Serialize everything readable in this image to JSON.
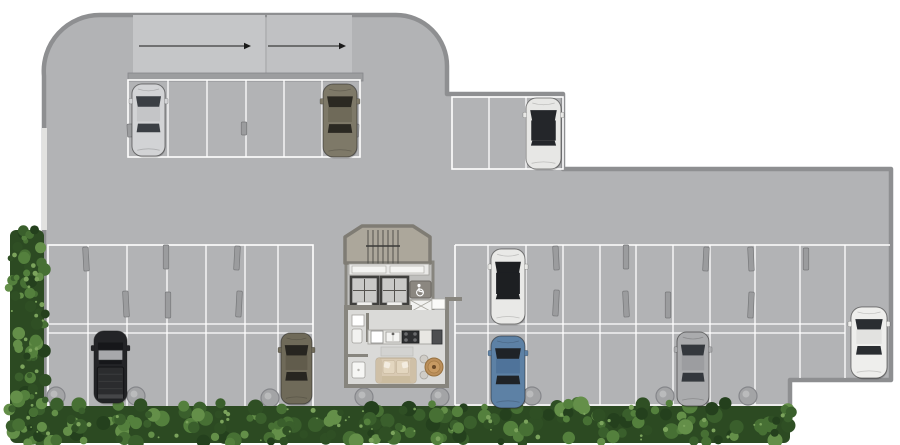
{
  "meta": {
    "title": "parking-level-floor-plan",
    "canvas": {
      "w": 900,
      "h": 445
    }
  },
  "palette": {
    "floor": "#b2b3b5",
    "wall": "#8e8f91",
    "line": "#ffffff",
    "ramp": "#c5c6c8",
    "ramp2": "#c0c1c3",
    "band": "#9c9d9f",
    "stop_fill": "#9b9c9e",
    "stop_edge": "#77787a",
    "column_fill": "#a3a4a6",
    "column_edge": "#85868a",
    "core_wall": "#87857e",
    "stair_floor": "#aca79b",
    "lobby_floor": "#dadad8",
    "elevator_frame": "#3f3f3d",
    "elevator_cab": "#c9c9c7",
    "sofa": "#d9cab3",
    "table": "#bb8f5b",
    "counter": "#e8e7e3",
    "arrow": "#1a1a1a"
  },
  "building": {
    "outline": "M 100,15 H 396 A 51 51 0 0 1 447,66 V 94 H 563 V 169 H 891 V 380 H 790 V 411 H 44 V 76 A 56 56 0 0 1 100,15 Z",
    "ramp_panels": [
      [
        133,
        15,
        132,
        58
      ],
      [
        267,
        15,
        85,
        58
      ]
    ],
    "wall_band": [
      128,
      73,
      235,
      8
    ],
    "left_wall_light": [
      42,
      128,
      5,
      102
    ]
  },
  "ramp_arrows": [
    {
      "x1": 139,
      "y": 46,
      "x2": 251
    },
    {
      "x1": 268,
      "y": 46,
      "x2": 346
    }
  ],
  "parking": {
    "sections": [
      {
        "name": "row-top-left",
        "box": [
          128,
          80,
          360,
          157
        ],
        "dividers": [
          168,
          207,
          246,
          284,
          322
        ]
      },
      {
        "name": "row-top-right",
        "box": [
          452,
          97,
          563,
          169
        ],
        "dividers": [
          489,
          526
        ]
      },
      {
        "name": "section-lower-left",
        "box": [
          48,
          245,
          313,
          408
        ],
        "dividers": [
          88,
          127,
          167,
          206,
          245,
          278
        ],
        "mid": [
          324,
          333
        ]
      },
      {
        "name": "section-lower-right",
        "box": [
          455,
          245,
          890,
          405
        ],
        "dividers": [
          488,
          526,
          563,
          600,
          636,
          673,
          710,
          755
        ],
        "dividers_short": [
          800,
          845
        ],
        "short_y2": 378,
        "mid": [
          324,
          333
        ],
        "mid_end": 845,
        "bottom_end": 790
      }
    ],
    "wheel_stops": [
      [
        130,
        124,
        13
      ],
      [
        244,
        122,
        13
      ],
      [
        356,
        124,
        13
      ],
      [
        86,
        247,
        24
      ],
      [
        166,
        245,
        24
      ],
      [
        237,
        246,
        24
      ],
      [
        126,
        291,
        26
      ],
      [
        168,
        292,
        26
      ],
      [
        239,
        291,
        26
      ],
      [
        556,
        246,
        24
      ],
      [
        626,
        245,
        24
      ],
      [
        706,
        247,
        24
      ],
      [
        751,
        247,
        24
      ],
      [
        806,
        248,
        22
      ],
      [
        556,
        290,
        26
      ],
      [
        626,
        291,
        26
      ],
      [
        668,
        292,
        26
      ],
      [
        751,
        292,
        26
      ]
    ],
    "columns": [
      [
        56,
        396
      ],
      [
        136,
        396
      ],
      [
        270,
        398
      ],
      [
        364,
        397
      ],
      [
        440,
        397
      ],
      [
        532,
        396
      ],
      [
        665,
        396
      ],
      [
        748,
        396
      ]
    ],
    "column_radius": 9
  },
  "landscaping": {
    "hedge_left": [
      10,
      230,
      34,
      213
    ],
    "hedge_bottom": [
      30,
      406,
      760,
      37
    ],
    "greens": [
      "#24401d",
      "#2f4f24",
      "#3a5f2c",
      "#477034",
      "#54803d",
      "#648f49"
    ],
    "highlight": "#7ba35c",
    "base": "#2c4a22"
  },
  "core": {
    "stair_hall": {
      "points": "345,263 345,237 362,226 413,226 430,237 430,263"
    },
    "rail": {
      "x1": 368,
      "x2": 398,
      "count": 7,
      "y1": 230,
      "y2": 264,
      "bar_y": 246,
      "bar_x1": 366,
      "bar_x2": 400
    },
    "elevator_block": [
      346,
      262,
      87,
      48
    ],
    "sill": {
      "x": 349,
      "y": 264,
      "w": 80,
      "h": 11,
      "doors": [
        [
          352,
          266,
          34,
          7
        ],
        [
          390,
          266,
          34,
          7
        ]
      ]
    },
    "elevators": [
      {
        "x": 351,
        "y": 277,
        "s": 27
      },
      {
        "x": 381,
        "y": 277,
        "s": 27
      }
    ],
    "elevator_doors": [
      [
        357,
        302,
        15,
        5
      ],
      [
        387,
        302,
        15,
        5
      ]
    ],
    "accessibility": {
      "x": 410,
      "y": 281,
      "w": 21,
      "h": 17
    },
    "vent": {
      "x": 410,
      "y": 300,
      "w": 22,
      "h": 12
    },
    "lobby": {
      "x": 348,
      "y": 310,
      "w": 97,
      "h": 74
    },
    "walls": [
      [
        344,
        305,
        68,
        5
      ],
      [
        344,
        310,
        4,
        78
      ],
      [
        344,
        384,
        105,
        4
      ],
      [
        445,
        297,
        4,
        91
      ],
      [
        449,
        297,
        13,
        4
      ],
      [
        366,
        313,
        3,
        29
      ],
      [
        348,
        354,
        20,
        3
      ]
    ],
    "door": {
      "x": 432,
      "y": 299,
      "w": 13,
      "h": 10
    },
    "kitchen": {
      "base": [
        368,
        330,
        74,
        14
      ],
      "appliance": [
        371,
        331,
        12,
        12
      ],
      "sink": [
        386,
        332,
        14,
        10
      ],
      "stove": [
        402,
        331,
        17,
        12
      ],
      "fridge": [
        432,
        330,
        10,
        14
      ]
    },
    "bench": [
      381,
      347,
      32,
      9
    ],
    "sofa": {
      "x": 376,
      "y": 358,
      "w": 40,
      "h": 25
    },
    "table": {
      "cx": 434,
      "cy": 367,
      "r": 9
    },
    "chairs": [
      [
        424,
        359
      ],
      [
        424,
        375
      ]
    ],
    "bath": {
      "cabinet": [
        352,
        315,
        12,
        11
      ],
      "basin": [
        352,
        329,
        10,
        14
      ],
      "shower": [
        352,
        362,
        13,
        16
      ]
    }
  },
  "cars": [
    {
      "name": "silver-sedan-top-left",
      "x": 132,
      "y": 84,
      "w": 33,
      "h": 72,
      "body": "#d2d3d5",
      "roof": "#c4c5c7",
      "glass": "#3b3f44",
      "facing": "up",
      "type": "sedan"
    },
    {
      "name": "olive-sedan-top-left",
      "x": 323,
      "y": 84,
      "w": 34,
      "h": 73,
      "body": "#7e7968",
      "roof": "#6f6a59",
      "glass": "#2b2922",
      "facing": "up",
      "type": "sedan"
    },
    {
      "name": "white-sedan-top-right",
      "x": 526,
      "y": 98,
      "w": 35,
      "h": 71,
      "body": "#e7e7e5",
      "roof": "#24262a",
      "glass": "#24262a",
      "facing": "up",
      "type": "sedan",
      "glassRoof": true
    },
    {
      "name": "black-pickup-lower-left",
      "x": 94,
      "y": 331,
      "w": 33,
      "h": 72,
      "body": "#232427",
      "roof": "#a7a8ab",
      "glass": "#16171a",
      "facing": "up",
      "type": "pickup"
    },
    {
      "name": "olive-sedan-lower-left",
      "x": 281,
      "y": 333,
      "w": 31,
      "h": 71,
      "body": "#6f6a59",
      "roof": "#615c4c",
      "glass": "#272520",
      "facing": "up",
      "type": "sedan"
    },
    {
      "name": "white-black-roof-sedan-upper-row",
      "x": 491,
      "y": 249,
      "w": 34,
      "h": 75,
      "body": "#e9e9e7",
      "roof": "#1d1f22",
      "glass": "#1d1f22",
      "facing": "up",
      "type": "sedan",
      "glassRoof": true
    },
    {
      "name": "blue-sedan-lower-row",
      "x": 491,
      "y": 336,
      "w": 34,
      "h": 72,
      "body": "#5d81a5",
      "roof": "#4f739a",
      "glass": "#1f2327",
      "facing": "up",
      "type": "sedan"
    },
    {
      "name": "gray-sedan-lower-row",
      "x": 677,
      "y": 332,
      "w": 32,
      "h": 74,
      "body": "#aaabad",
      "roof": "#9c9da0",
      "glass": "#34383d",
      "facing": "up",
      "type": "sedan"
    },
    {
      "name": "white-coupe-far-right",
      "x": 851,
      "y": 307,
      "w": 36,
      "h": 71,
      "body": "#eeeeec",
      "roof": "#e2e2e0",
      "glass": "#2a2d31",
      "facing": "up",
      "type": "sedan"
    }
  ]
}
